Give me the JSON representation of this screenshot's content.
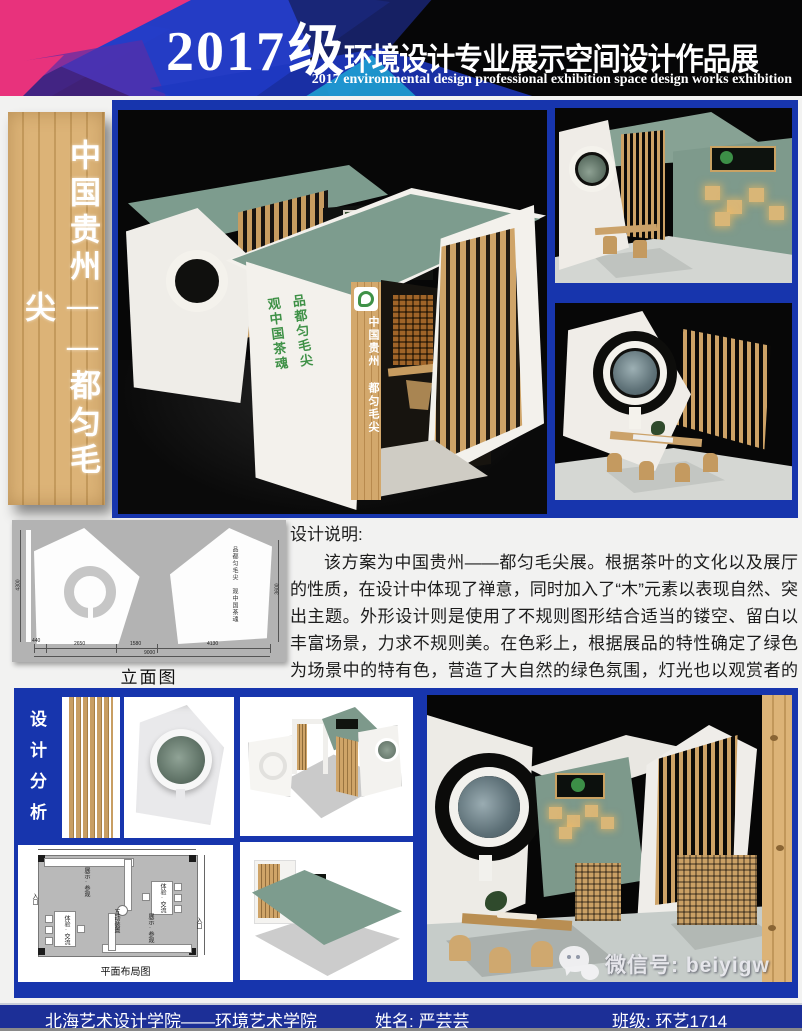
{
  "header": {
    "title_year": "2017",
    "title_grade": "级",
    "title_rest": "环境设计专业展示空间设计作品展",
    "subtitle_en": "2017 environmental design professional exhibition space design works exhibition"
  },
  "banner": {
    "calligraphy": "中国贵州——都匀毛尖"
  },
  "main_render": {
    "slogan_col1": "品都匀毛尖",
    "slogan_col2": "观中国茶魂",
    "pillar_text": "中国贵州 都匀毛尖"
  },
  "elevation": {
    "caption": "立面图",
    "dim_left": "4300",
    "dim_right": "3600",
    "dim_b1": "440",
    "dim_b2": "2650",
    "dim_b3": "1580",
    "dim_b4": "4130",
    "dim_total": "9000",
    "wall_text": "品都匀毛尖 观中国茶魂"
  },
  "description": {
    "heading": "设计说明:",
    "body": "该方案为中国贵州——都匀毛尖展。根据茶叶的文化以及展厅的性质，在设计中体现了禅意，同时加入了“木”元素以表现自然、突出主题。外形设计则是使用了不规则图形结合适当的镂空、留白以丰富场景，力求不规则美。在色彩上，根据展品的特性确定了绿色为场景中的特有色，营造了大自然的绿色氛围，灯光也以观赏者的体验为主，使用较为柔和的灯光。"
  },
  "analysis": {
    "label": "设计分析"
  },
  "floorplan": {
    "caption": "平面布局图",
    "label_entry_left": "入口",
    "label_entry_right": "入口",
    "label_display_top": "展示·参观",
    "label_display_bottom": "展示·参观",
    "label_exp_left": "体验·交流",
    "label_exp_right": "体验·交流",
    "label_center": "互动装置"
  },
  "footer": {
    "school": "北海艺术设计学院——环境艺术学院",
    "name": "姓名: 严芸芸",
    "class": "班级: 环艺1714"
  },
  "watermark": {
    "wechat": "微信号: beiyigw"
  },
  "colors": {
    "panel_blue": "#1735ad",
    "footer_blue": "#1c2f97",
    "roof_green": "#7d9c8e",
    "wood": "#d2a468",
    "calligraphy_green": "#3f9147",
    "accent_pink": "#e8327c"
  }
}
